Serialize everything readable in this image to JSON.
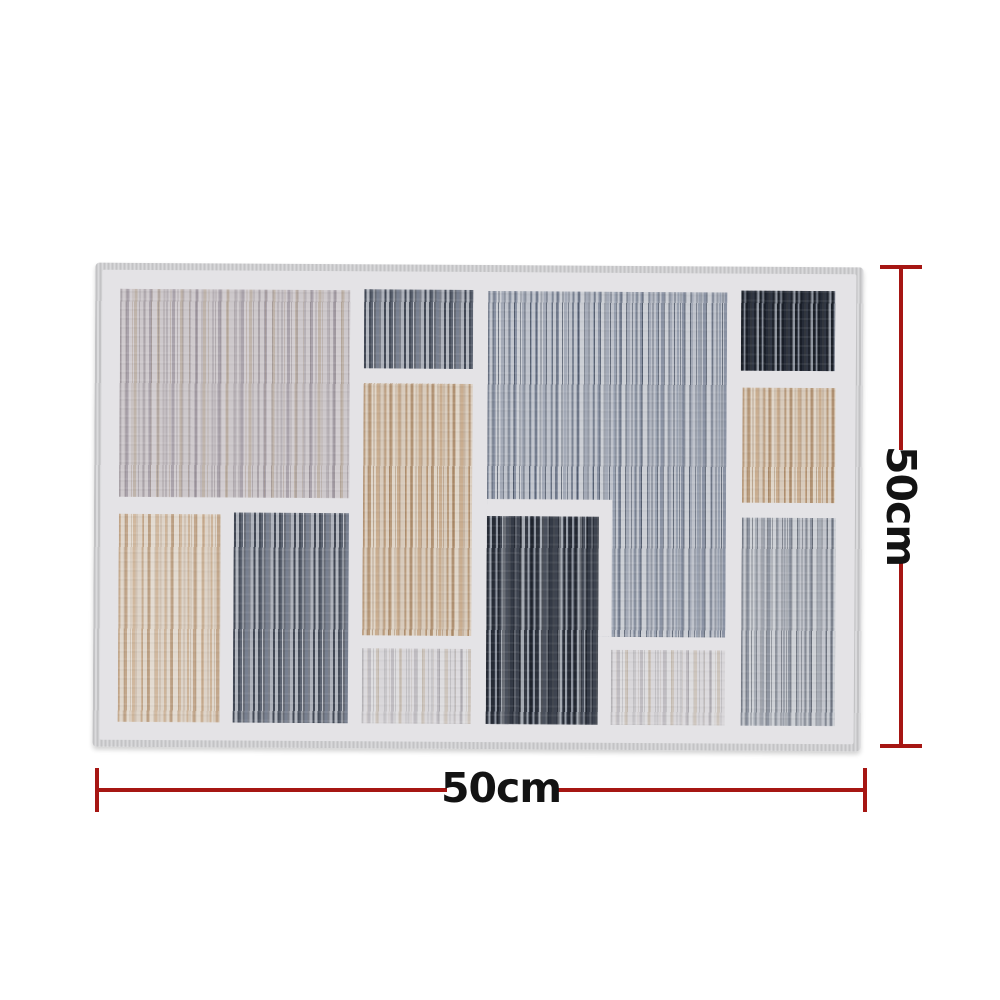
{
  "page": {
    "background": "#ffffff",
    "description_label": "rug product photo with dimension lines"
  },
  "dimensions": {
    "width_label": "50cm",
    "height_label": "50cm",
    "unit": "cm",
    "line_color": "#a61613",
    "label_color": "#131313"
  },
  "rug": {
    "edge_color": "#cfcfd1",
    "field_color": "#e4e3e6",
    "tone_colors": {
      "taupe": "#bcb5b4",
      "slate": "#9aa2b0",
      "slate-dark": "#6d7482",
      "charcoal": "#3e4450",
      "black": "#313744",
      "tan": "#c4a88b",
      "tan-light": "#cdb49a",
      "gray": "#a0a5af",
      "pale": "#cfcdd0",
      "field": "#e4e3e6"
    },
    "panels": [
      {
        "id": "top-left",
        "tone": "taupe",
        "x": 25,
        "y": 26,
        "w": 230,
        "h": 208
      },
      {
        "id": "upper-mid-small",
        "tone": "slate-dark",
        "x": 269,
        "y": 25,
        "w": 109,
        "h": 79
      },
      {
        "id": "upper-right-large",
        "tone": "slate",
        "x": 393,
        "y": 26,
        "w": 239,
        "h": 345,
        "z": 1
      },
      {
        "id": "upper-right-notch",
        "tone": "field",
        "x": 393,
        "y": 234,
        "w": 125,
        "h": 137,
        "z": 2
      },
      {
        "id": "top-right-small",
        "tone": "black",
        "x": 646,
        "y": 24,
        "w": 94,
        "h": 80
      },
      {
        "id": "mid-tan-column",
        "tone": "tan",
        "x": 269,
        "y": 119,
        "w": 109,
        "h": 252
      },
      {
        "id": "right-tan-small",
        "tone": "tan",
        "x": 648,
        "y": 121,
        "w": 93,
        "h": 115
      },
      {
        "id": "bottom-left-tan",
        "tone": "tan-light",
        "x": 25,
        "y": 251,
        "w": 102,
        "h": 208
      },
      {
        "id": "bottom-left-dark",
        "tone": "slate-dark",
        "x": 140,
        "y": 249,
        "w": 115,
        "h": 210
      },
      {
        "id": "bottom-mid-dark",
        "tone": "charcoal",
        "x": 393,
        "y": 251,
        "w": 112,
        "h": 208,
        "z": 3
      },
      {
        "id": "bottom-right-gray",
        "tone": "gray",
        "x": 648,
        "y": 251,
        "w": 94,
        "h": 208
      },
      {
        "id": "bottom-mid-pale-left",
        "tone": "pale",
        "x": 269,
        "y": 384,
        "w": 109,
        "h": 75
      },
      {
        "id": "bottom-mid-pale-right",
        "tone": "pale",
        "x": 518,
        "y": 384,
        "w": 114,
        "h": 75
      }
    ]
  }
}
